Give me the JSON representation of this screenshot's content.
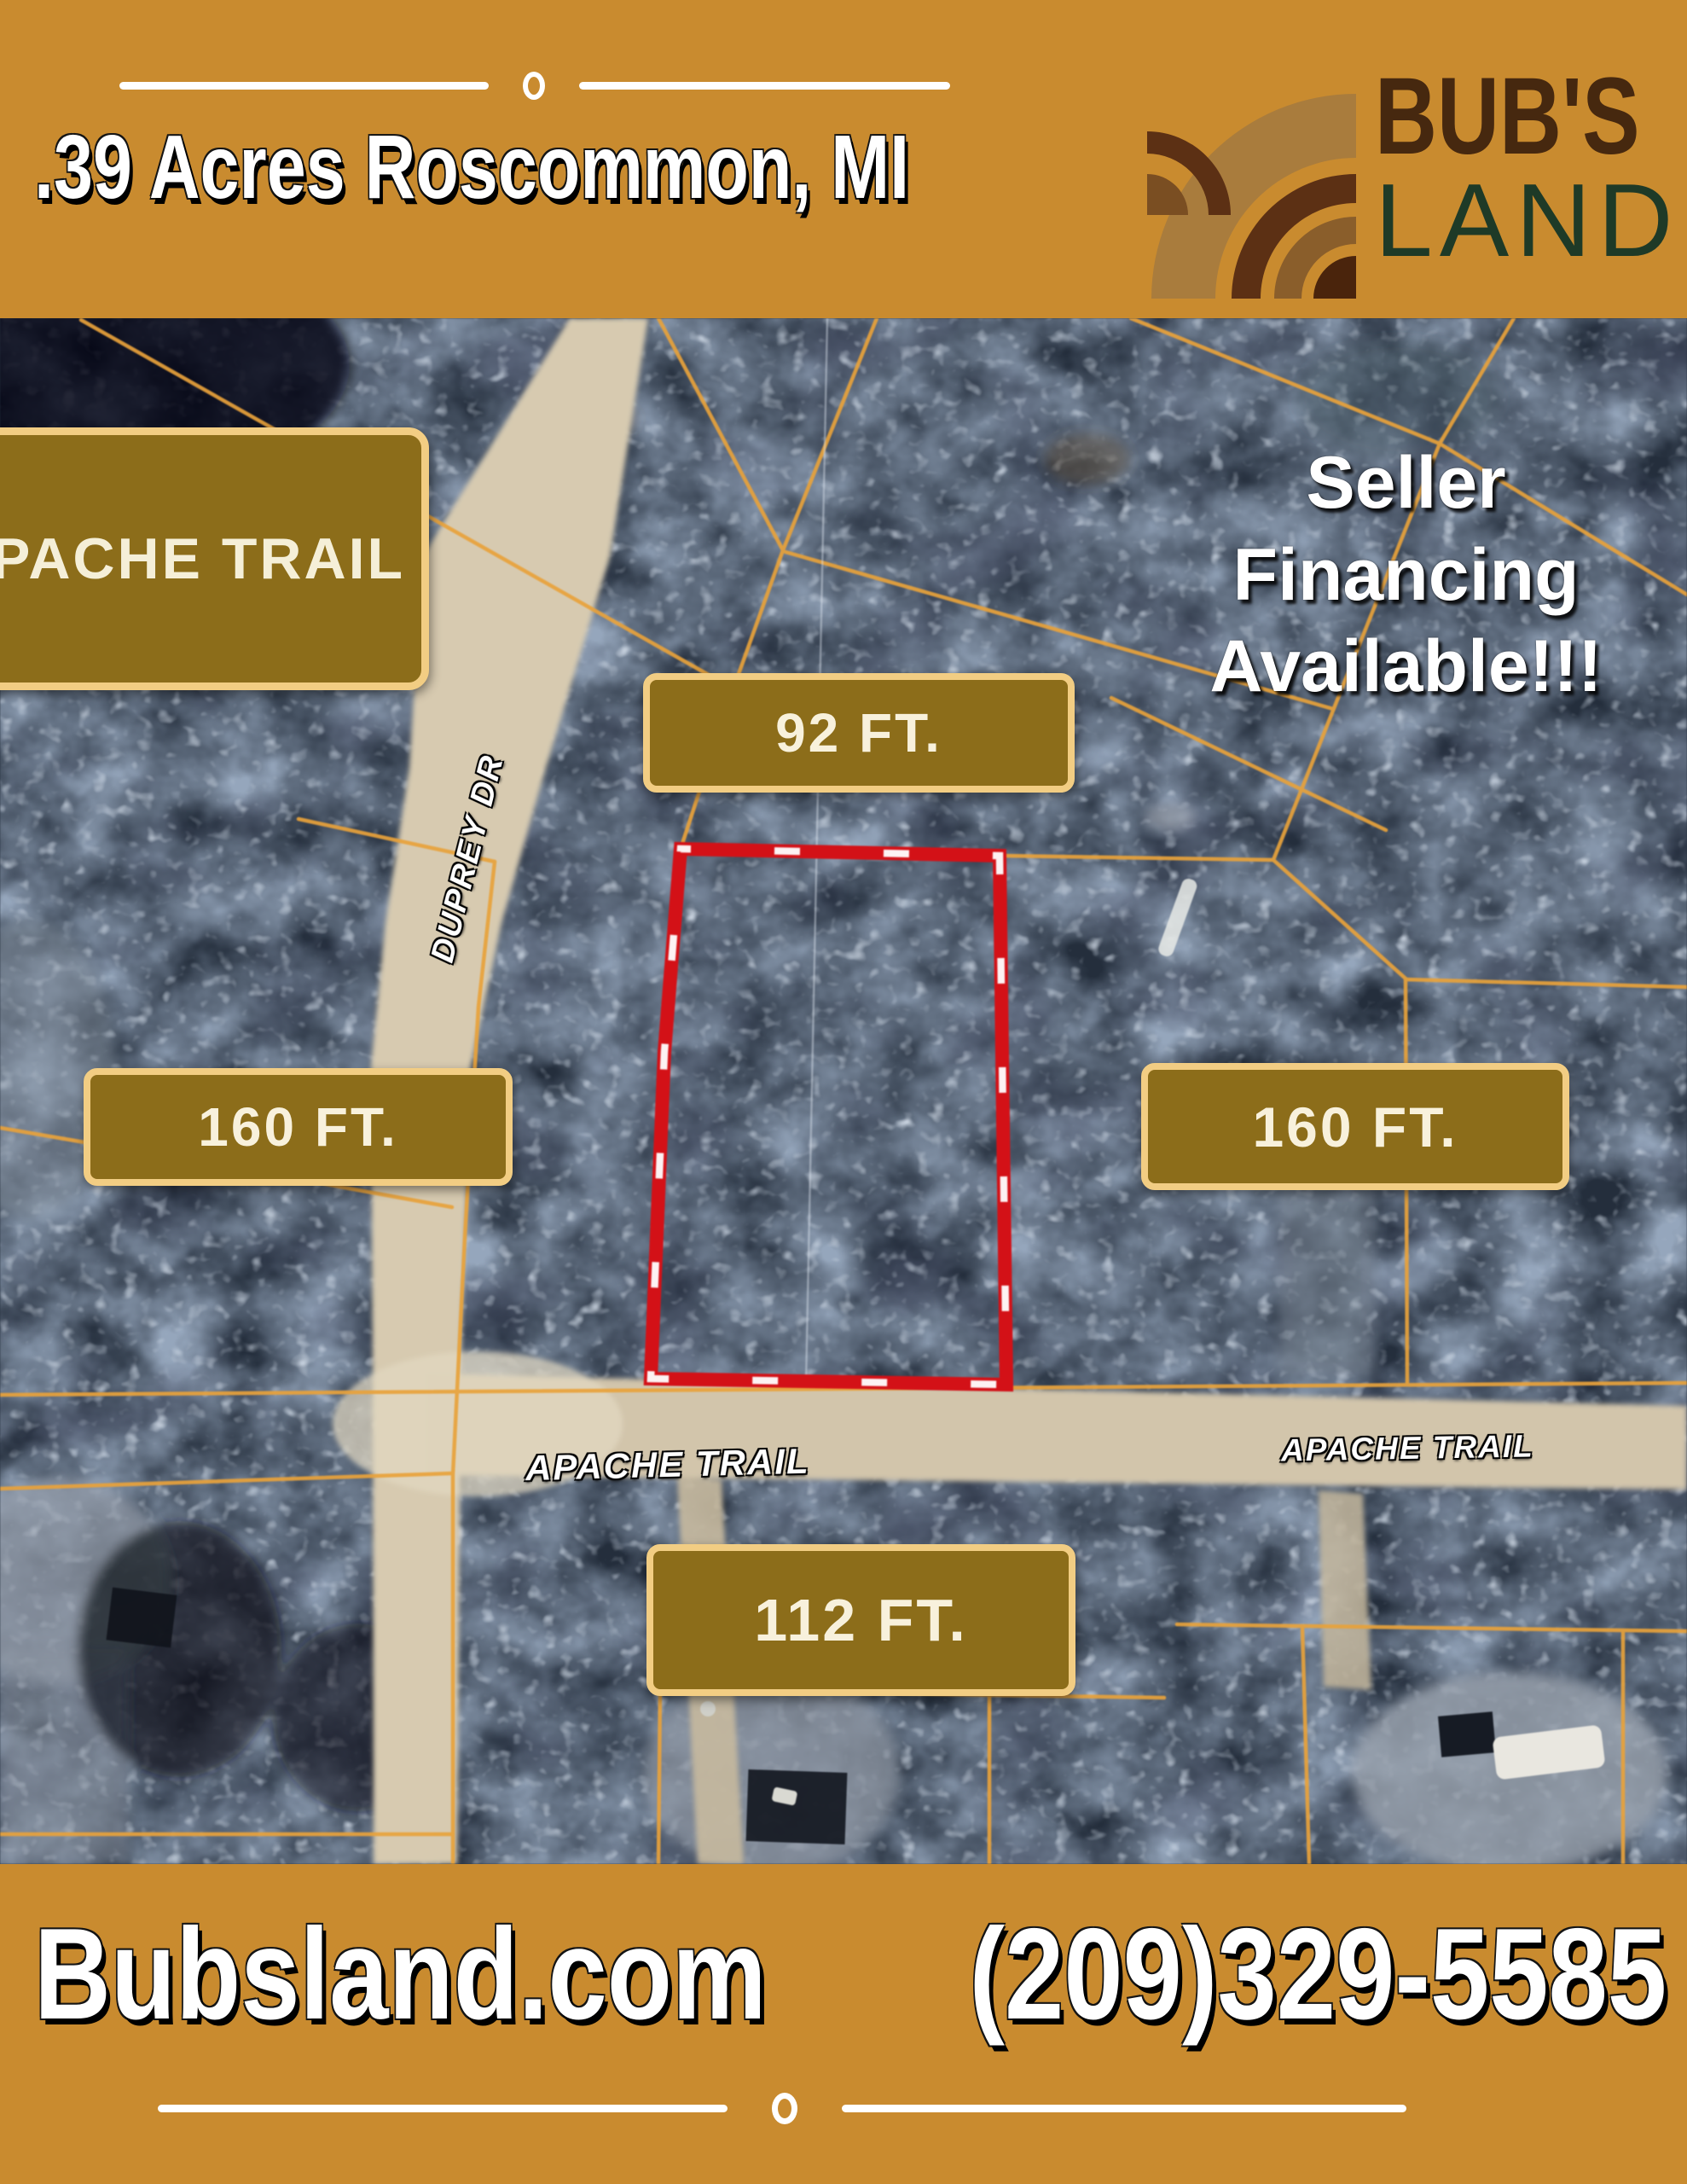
{
  "header": {
    "title": ".39 Acres Roscommon, MI",
    "brand": {
      "name_top": "BUB'S",
      "name_bottom": "LAND",
      "icon": "plowed-field-icon"
    }
  },
  "map": {
    "street_sign": "APACHE TRAIL",
    "promo": {
      "line1": "Seller",
      "line2": "Financing",
      "line3": "Available!!!"
    },
    "measurements": {
      "top": "92 FT.",
      "left": "160 FT.",
      "right": "160 FT.",
      "bottom": "112 FT."
    },
    "roads": {
      "duprey": "DUPREY DR",
      "apache_left": "APACHE TRAIL",
      "apache_right": "APACHE TRAIL"
    }
  },
  "footer": {
    "website": "Bubsland.com",
    "phone": "(209)329-5585"
  },
  "colors": {
    "gold": "#C98B2F",
    "label_fill": "#8C6D1A",
    "label_border": "#F2CD83",
    "label_text": "#F8F1DC",
    "boundary_red": "#D31117",
    "parcel_line": "#E8A23B",
    "road_tan": "#D7CAB0",
    "forest_dark": "#242E3C"
  }
}
